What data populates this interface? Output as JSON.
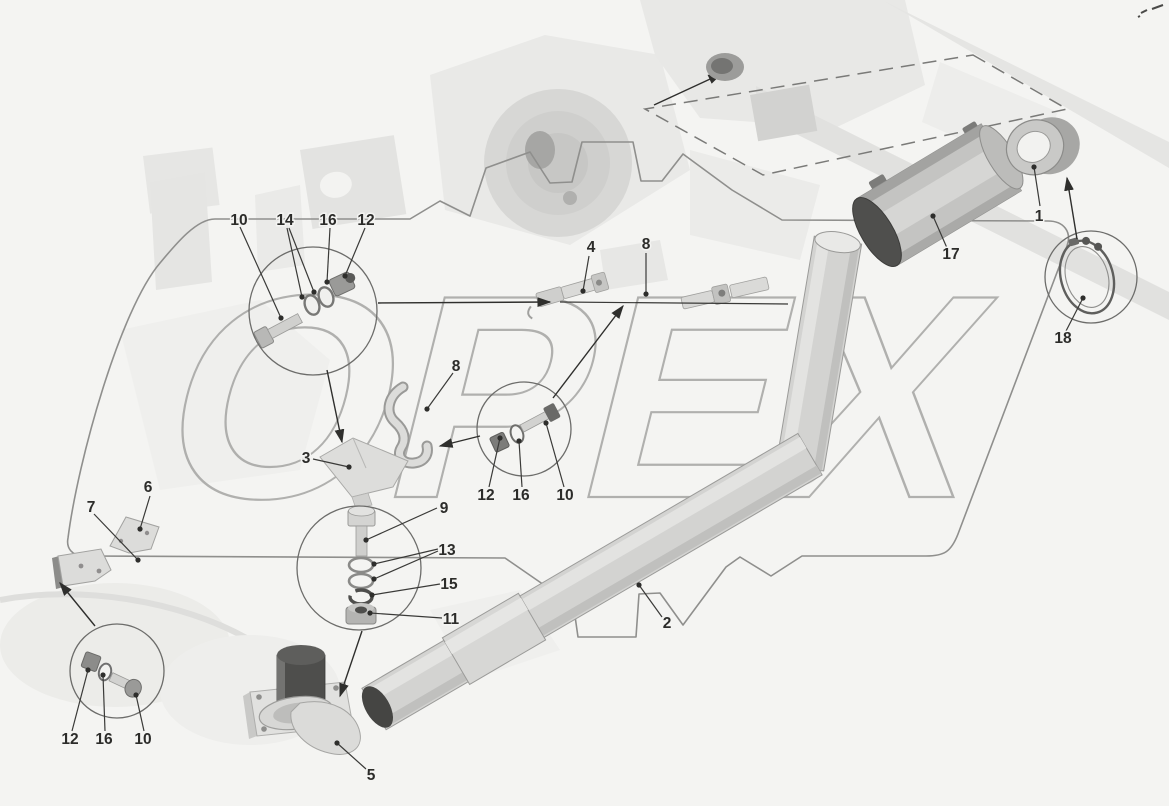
{
  "page": {
    "background": "#f4f4f2"
  },
  "colors": {
    "label": "#2c2c2a",
    "leader_line": "#3a3a38",
    "border": "#8f8f8d",
    "watermark_stroke": "#a5a5a3",
    "pipe_fill": "#d3d3d1",
    "dark_end": "#454543"
  },
  "watermark": {
    "text": "ОРЕХ"
  },
  "callouts": [
    {
      "number": "10"
    },
    {
      "number": "14"
    },
    {
      "number": "16"
    },
    {
      "number": "12"
    },
    {
      "number": "4"
    },
    {
      "number": "8"
    },
    {
      "number": "1"
    },
    {
      "number": "17"
    },
    {
      "number": "18"
    },
    {
      "number": "8"
    },
    {
      "number": "3"
    },
    {
      "number": "12"
    },
    {
      "number": "16"
    },
    {
      "number": "10"
    },
    {
      "number": "9"
    },
    {
      "number": "13"
    },
    {
      "number": "15"
    },
    {
      "number": "11"
    },
    {
      "number": "6"
    },
    {
      "number": "7"
    },
    {
      "number": "2"
    },
    {
      "number": "12"
    },
    {
      "number": "16"
    },
    {
      "number": "10"
    },
    {
      "number": "5"
    }
  ]
}
